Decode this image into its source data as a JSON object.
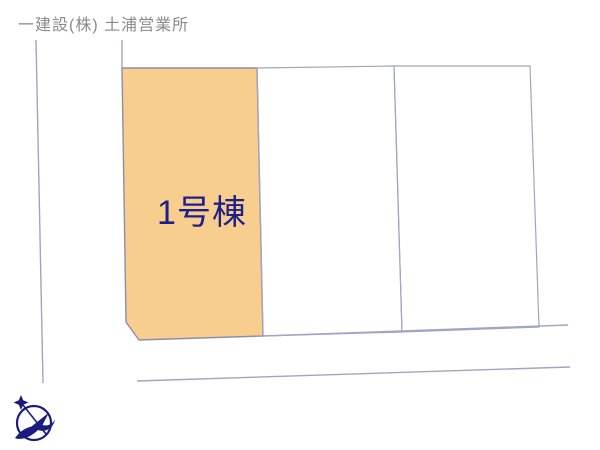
{
  "header": {
    "company": "一建設(株) 土浦営業所"
  },
  "site_plan": {
    "plots": [
      {
        "label": "1号棟",
        "highlighted": true
      },
      {
        "label": "",
        "highlighted": false
      },
      {
        "label": "",
        "highlighted": false
      }
    ]
  },
  "icons": {
    "compass_north": "north-arrow-compass"
  },
  "colors": {
    "page_bg": "#FFFFFF",
    "header_text": "#8A8A8A",
    "plot_fill": "#F7CE8D",
    "plot_stroke": "#8D8DAD",
    "boundary": "#A3A3C2",
    "plot_label": "#1F1F8C",
    "compass": "#1A1A80"
  }
}
